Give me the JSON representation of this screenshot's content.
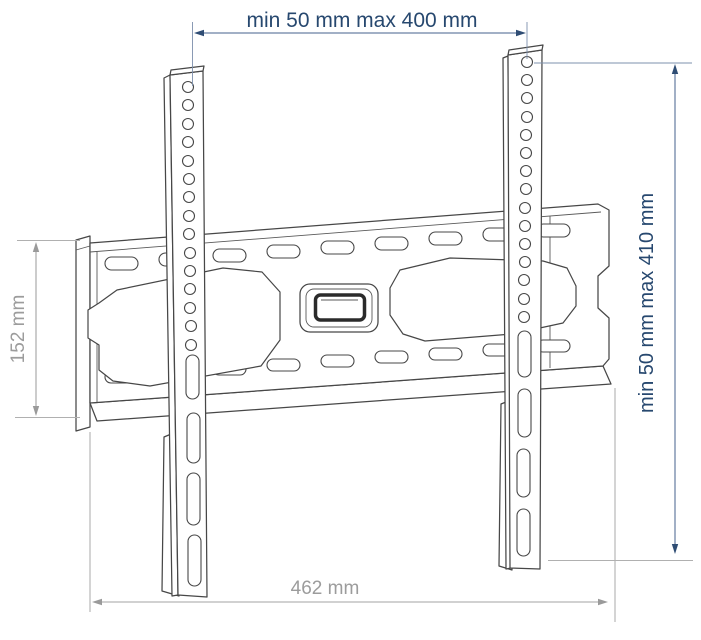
{
  "diagram": {
    "type": "technical-drawing",
    "subject": "TV wall-mount bracket with mounting rails",
    "dimensions": {
      "top": "min 50 mm max 400 mm",
      "right": "min 50 mm max 410 mm",
      "left": "152 mm",
      "bottom": "462 mm"
    },
    "colors": {
      "dimension_accent": "#27486f",
      "dimension_gray": "#9c9c9c",
      "outline": "#474747",
      "background": "#ffffff"
    }
  }
}
